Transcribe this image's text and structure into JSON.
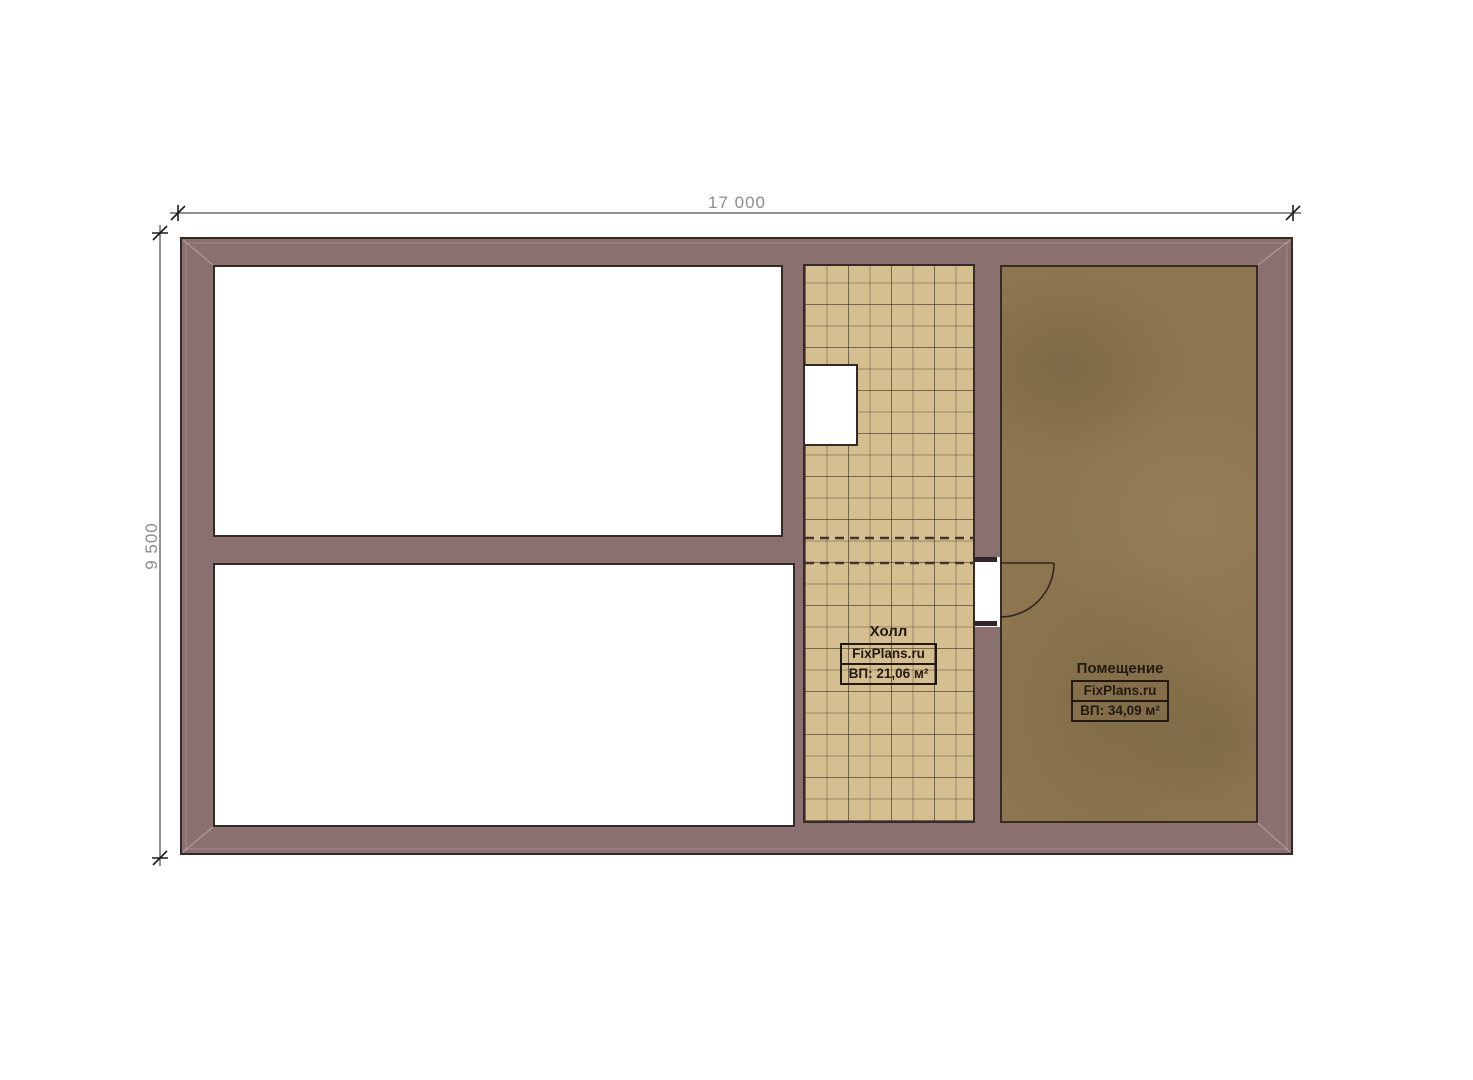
{
  "plan": {
    "dimensions": {
      "width_label": "17 000",
      "height_label": "9 500"
    },
    "rooms": {
      "hall": {
        "name": "Холл",
        "brand": "FixPlans.ru",
        "area": "ВП: 21,06 м²"
      },
      "premise": {
        "name": "Помещение",
        "brand": "FixPlans.ru",
        "area": "ВП: 34,09 м²"
      }
    }
  },
  "colors": {
    "wall": "#8a7170",
    "wall-outline": "#342a27",
    "tile": "#d5bf90",
    "floor": "#8d764f",
    "dim-text": "#8c8c8c",
    "dim-line": "#4a4a4a",
    "label-text": "#221a12"
  }
}
